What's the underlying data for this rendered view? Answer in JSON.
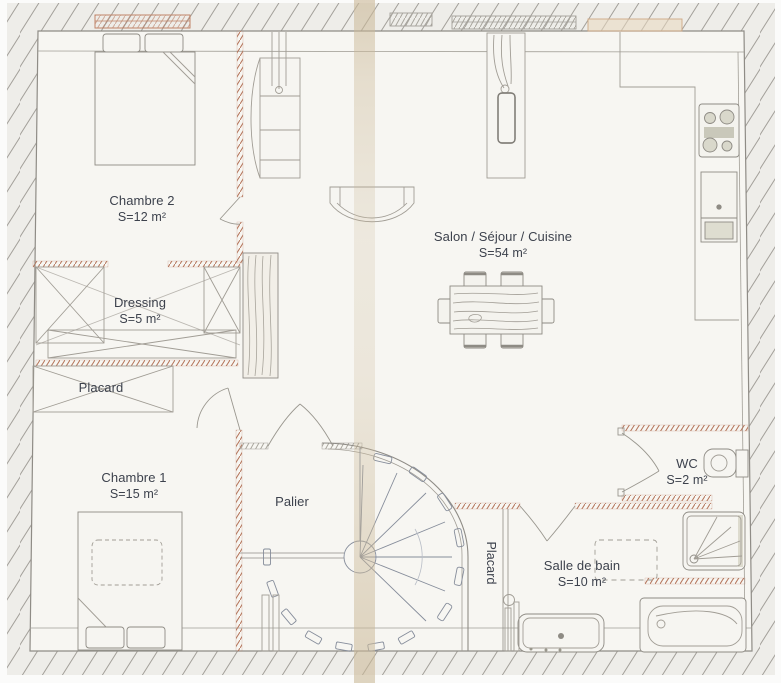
{
  "rooms": {
    "chambre2": {
      "name": "Chambre 2",
      "area": "S=12 m²"
    },
    "dressing": {
      "name": "Dressing",
      "area": "S=5 m²"
    },
    "placard_upper": {
      "name": "Placard"
    },
    "chambre1": {
      "name": "Chambre 1",
      "area": "S=15 m²"
    },
    "palier": {
      "name": "Palier"
    },
    "salon": {
      "name": "Salon / Séjour / Cuisine",
      "area": "S=54 m²"
    },
    "wc": {
      "name": "WC",
      "area": "S=2 m²"
    },
    "salle_de_bain": {
      "name": "Salle de bain",
      "area": "S=10 m²"
    },
    "placard_bath": {
      "name": "Placard"
    }
  },
  "fixtures": [
    "double-bed",
    "pillows",
    "armoire",
    "radiator-pipes",
    "sofa",
    "chimney-flue",
    "dining-table",
    "chairs",
    "wardrobe-cross-placard",
    "kitchen-counter",
    "cooktop",
    "kitchen-sink",
    "built-in-closet",
    "spiral-staircase",
    "washing-machine-dashed",
    "vanity-basin",
    "bathtub",
    "shower",
    "toilet",
    "towel-radiator"
  ],
  "colors": {
    "paper": "#f7f6f2",
    "hatch_background": "#eeede9",
    "hatch_line": "#a3a09a",
    "wall_line": "#8f8c86",
    "furniture_line": "#a19d95",
    "partition_stipple": "#b5765c",
    "label_text": "#3d424d",
    "fold_stain": "#cbb998"
  }
}
